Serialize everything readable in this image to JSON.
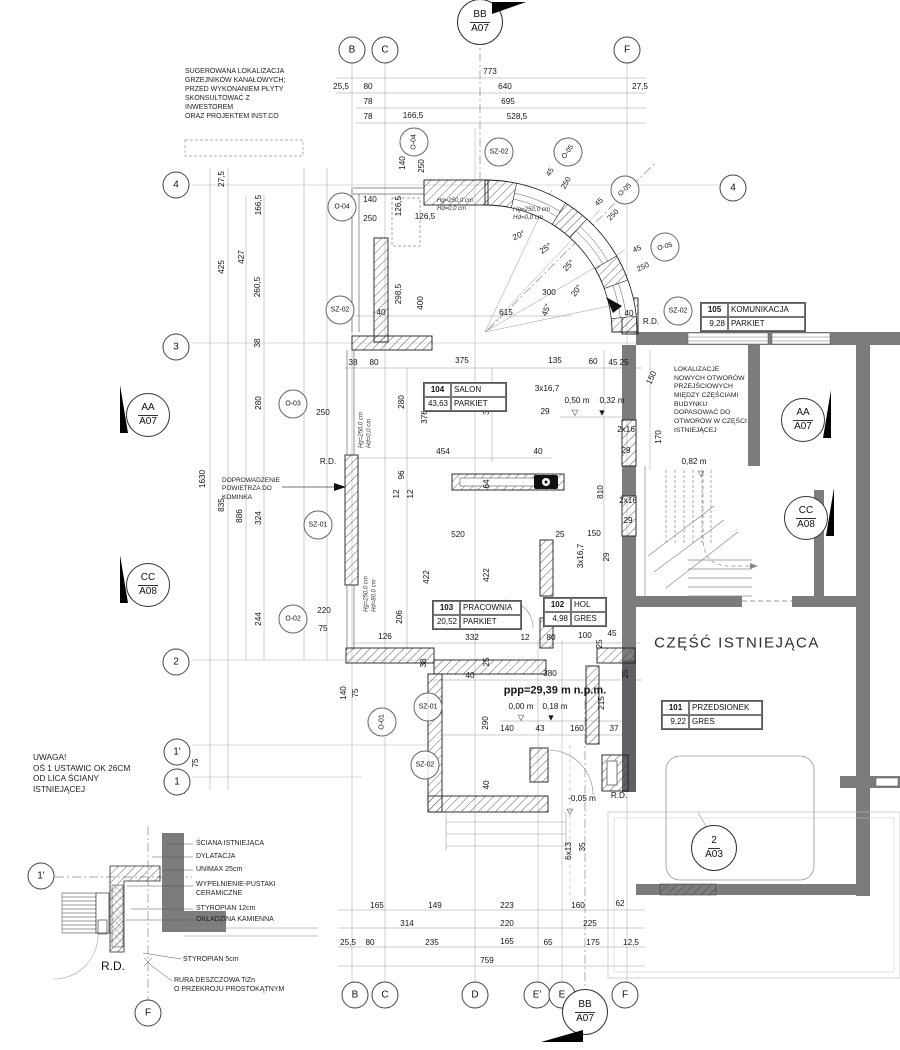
{
  "colors": {
    "existing_wall": "#7c7c7c",
    "existing_wall_dark": "#606165",
    "line": "#555555",
    "dim_text": "#141414",
    "bg": "#ffffff"
  },
  "plan": {
    "big_label": {
      "t": "CZĘŚĆ ISTNIEJĄCA",
      "x": 737,
      "y": 643
    },
    "notes": [
      {
        "n": "note-suggested-heaters",
        "t": "SUGEROWANA LOKALIZACJA\nGRZEJNIKÓW KANAŁOWYCH;\nPRZED WYKONANIEM PŁYTY\nSKONSULTOWAĆ Z\nINWESTOREM\nORAZ PROJEKTEM INST.CO",
        "x": 185,
        "y": 68,
        "fs": 7
      },
      {
        "n": "note-new-openings",
        "t": "LOKALIZACJE\nNOWYCH OTWORÓW\nPRZEJŚCIOWYCH\nMIĘDZY CZĘŚCIAMI\nBUDYNKU\nDOPASOWAĆ DO\nOTWORÓW W CZĘŚCI\nISTNIEJĄCEJ",
        "x": 674,
        "y": 366,
        "fs": 6.8
      },
      {
        "n": "note-axis-warning",
        "t": "UWAGA!\nOŚ 1 USTAWIC OK 26CM\nOD LICA ŚCIANY\nISTNIEJĄCEJ",
        "x": 33,
        "y": 752,
        "fs": 8.3
      },
      {
        "n": "note-fireplace-air",
        "t": "DOPROWADZENIE\nPOWIETRZA DO\nKOMINKA",
        "x": 222,
        "y": 477,
        "fs": 6.5
      },
      {
        "n": "window-params",
        "t": "Hg=250,0 cm\nHd=0,0 cm",
        "x": 437,
        "y": 198,
        "fs": 6,
        "i": 1
      },
      {
        "n": "window-params",
        "t": "Hg=250,0 cm\nHd=0,0 cm",
        "x": 513,
        "y": 206,
        "fs": 6.2,
        "i": 1
      },
      {
        "n": "window-params",
        "t": "Hg=250,0 cm\nHd=0,0 cm",
        "x": 366,
        "y": 430,
        "fs": 6,
        "i": 1,
        "r": -90
      },
      {
        "n": "window-params",
        "t": "Hg=250,0 cm\nHd=80,0 cm",
        "x": 371,
        "y": 594,
        "fs": 6,
        "i": 1,
        "r": -90
      },
      {
        "n": "detail-label",
        "t": "ŚCIANA ISTNIEJĄCA",
        "x": 196,
        "y": 840,
        "fs": 7
      },
      {
        "n": "detail-label",
        "t": "DYLATACJA",
        "x": 196,
        "y": 853,
        "fs": 7
      },
      {
        "n": "detail-label",
        "t": "UNIMAX 25cm",
        "x": 196,
        "y": 866,
        "fs": 7
      },
      {
        "n": "detail-label",
        "t": "WYPEŁNIENIE-PUSTAKI\nCERAMICZNE",
        "x": 196,
        "y": 881,
        "fs": 7
      },
      {
        "n": "detail-label",
        "t": "STYROPIAN 12cm",
        "x": 196,
        "y": 905,
        "fs": 7
      },
      {
        "n": "detail-label",
        "t": "OKŁADZINA KAMIENNA",
        "x": 196,
        "y": 916,
        "fs": 7
      },
      {
        "n": "detail-label",
        "t": "STYROPIAN 5cm",
        "x": 183,
        "y": 956,
        "fs": 7
      },
      {
        "n": "detail-label",
        "t": "RURA DESZCZOWA TiZn\nO PRZEKROJU PROSTOKĄTNYM",
        "x": 174,
        "y": 977,
        "fs": 7
      }
    ],
    "rooms": [
      {
        "num": "104",
        "name": "SALON",
        "area": "43,63",
        "fin": "PARKIET",
        "x": 423,
        "y": 382,
        "w": 82
      },
      {
        "num": "103",
        "name": "PRACOWNIA",
        "area": "20,52",
        "fin": "PARKIET",
        "x": 432,
        "y": 600,
        "w": 88
      },
      {
        "num": "102",
        "name": "HOL",
        "area": "4,98",
        "fin": "GRES",
        "x": 543,
        "y": 597,
        "w": 62
      },
      {
        "num": "105",
        "name": "KOMUNIKACJA",
        "area": "9,28",
        "fin": "PARKIET",
        "x": 700,
        "y": 302,
        "w": 104
      },
      {
        "num": "101",
        "name": "PRZEDSIONEK",
        "area": "9,22",
        "fin": "GRES",
        "x": 661,
        "y": 700,
        "w": 100
      }
    ],
    "grid_bubbles": [
      {
        "t": "B",
        "x": 352,
        "y": 50
      },
      {
        "t": "C",
        "x": 385,
        "y": 50
      },
      {
        "t": "F",
        "x": 627,
        "y": 50
      },
      {
        "t": "4",
        "x": 733,
        "y": 188
      },
      {
        "t": "4",
        "x": 176,
        "y": 185
      },
      {
        "t": "3",
        "x": 176,
        "y": 347
      },
      {
        "t": "2",
        "x": 176,
        "y": 662
      },
      {
        "t": "1'",
        "x": 177,
        "y": 752
      },
      {
        "t": "1",
        "x": 177,
        "y": 782
      },
      {
        "t": "B",
        "x": 355,
        "y": 995
      },
      {
        "t": "C",
        "x": 385,
        "y": 995
      },
      {
        "t": "D",
        "x": 475,
        "y": 995
      },
      {
        "t": "E'",
        "x": 537,
        "y": 995
      },
      {
        "t": "E",
        "x": 562,
        "y": 995
      },
      {
        "t": "F",
        "x": 625,
        "y": 995
      },
      {
        "t": "1'",
        "x": 41,
        "y": 876
      },
      {
        "t": "F",
        "x": 148,
        "y": 1013
      }
    ],
    "tag_bubbles": [
      {
        "t": "O-04",
        "x": 342,
        "y": 207
      },
      {
        "t": "O-04",
        "x": 414,
        "y": 142,
        "r": -90
      },
      {
        "t": "SZ-02",
        "x": 499,
        "y": 152
      },
      {
        "t": "O-05",
        "x": 568,
        "y": 152,
        "r": -55
      },
      {
        "t": "O-05",
        "x": 625,
        "y": 190,
        "r": -45
      },
      {
        "t": "O-05",
        "x": 665,
        "y": 247,
        "r": -15
      },
      {
        "t": "SZ-02",
        "x": 340,
        "y": 310
      },
      {
        "t": "O-03",
        "x": 293,
        "y": 404
      },
      {
        "t": "SZ-01",
        "x": 318,
        "y": 525
      },
      {
        "t": "O-02",
        "x": 293,
        "y": 619
      },
      {
        "t": "O-01",
        "x": 382,
        "y": 722,
        "r": -90
      },
      {
        "t": "SZ-01",
        "x": 428,
        "y": 707
      },
      {
        "t": "SZ-02",
        "x": 425,
        "y": 765
      },
      {
        "t": "SZ-02",
        "x": 678,
        "y": 311
      }
    ],
    "section_markers": [
      {
        "t1": "BB",
        "t2": "A07",
        "x": 480,
        "y": 22,
        "d": 44,
        "flag": "tr"
      },
      {
        "t1": "AA",
        "t2": "A07",
        "x": 148,
        "y": 415,
        "d": 42,
        "flag": "lu"
      },
      {
        "t1": "CC",
        "t2": "A08",
        "x": 148,
        "y": 585,
        "d": 42,
        "flag": "lu"
      },
      {
        "t1": "AA",
        "t2": "A07",
        "x": 803,
        "y": 420,
        "d": 42,
        "flag": "ru"
      },
      {
        "t1": "CC",
        "t2": "A08",
        "x": 806,
        "y": 518,
        "d": 42,
        "flag": "ru"
      },
      {
        "t1": "BB",
        "t2": "A07",
        "x": 585,
        "y": 1012,
        "d": 44,
        "flag": "bl"
      },
      {
        "t1": "2",
        "t2": "A03",
        "x": 714,
        "y": 848,
        "d": 44,
        "flag": ""
      }
    ],
    "labels": [
      {
        "t": "773",
        "x": 490,
        "y": 72
      },
      {
        "t": "25,5",
        "x": 341,
        "y": 87
      },
      {
        "t": "80",
        "x": 368,
        "y": 87
      },
      {
        "t": "640",
        "x": 505,
        "y": 87
      },
      {
        "t": "27,5",
        "x": 640,
        "y": 87
      },
      {
        "t": "78",
        "x": 368,
        "y": 102
      },
      {
        "t": "695",
        "x": 508,
        "y": 102
      },
      {
        "t": "78",
        "x": 368,
        "y": 117
      },
      {
        "t": "166,5",
        "x": 413,
        "y": 116
      },
      {
        "t": "528,5",
        "x": 517,
        "y": 117
      },
      {
        "t": "27,5",
        "x": 222,
        "y": 179,
        "r": -90
      },
      {
        "t": "166,5",
        "x": 259,
        "y": 205,
        "r": -90
      },
      {
        "t": "425",
        "x": 222,
        "y": 267,
        "r": -90
      },
      {
        "t": "427",
        "x": 242,
        "y": 257,
        "r": -90
      },
      {
        "t": "260,5",
        "x": 258,
        "y": 287,
        "r": -90
      },
      {
        "t": "38",
        "x": 258,
        "y": 343,
        "r": -90
      },
      {
        "t": "280",
        "x": 259,
        "y": 403,
        "r": -90
      },
      {
        "t": "1630",
        "x": 203,
        "y": 479,
        "r": -90
      },
      {
        "t": "835",
        "x": 222,
        "y": 505,
        "r": -90
      },
      {
        "t": "886",
        "x": 240,
        "y": 516,
        "r": -90
      },
      {
        "t": "324",
        "x": 259,
        "y": 518,
        "r": -90
      },
      {
        "t": "244",
        "x": 259,
        "y": 619,
        "r": -90
      },
      {
        "t": "75",
        "x": 196,
        "y": 763,
        "r": -90
      },
      {
        "t": "27,5",
        "x": 183,
        "y": 786,
        "r": -90
      },
      {
        "t": "250",
        "x": 323,
        "y": 413
      },
      {
        "t": "220",
        "x": 324,
        "y": 611
      },
      {
        "t": "75",
        "x": 323,
        "y": 629
      },
      {
        "t": "R.D.",
        "x": 328,
        "y": 462
      },
      {
        "t": "140",
        "x": 370,
        "y": 200
      },
      {
        "t": "250",
        "x": 370,
        "y": 219
      },
      {
        "t": "140",
        "x": 403,
        "y": 163,
        "r": -90
      },
      {
        "t": "250",
        "x": 422,
        "y": 166,
        "r": -90
      },
      {
        "t": "126,5",
        "x": 399,
        "y": 206,
        "r": -90
      },
      {
        "t": "126,5",
        "x": 425,
        "y": 217
      },
      {
        "t": "298,5",
        "x": 399,
        "y": 294,
        "r": -90
      },
      {
        "t": "400",
        "x": 421,
        "y": 303,
        "r": -90
      },
      {
        "t": "40",
        "x": 381,
        "y": 313
      },
      {
        "t": "615",
        "x": 506,
        "y": 313
      },
      {
        "t": "300",
        "x": 549,
        "y": 293
      },
      {
        "t": "45",
        "x": 550,
        "y": 172,
        "r": -60,
        "fs": 7.5
      },
      {
        "t": "250",
        "x": 566,
        "y": 183,
        "r": -60,
        "fs": 7.5
      },
      {
        "t": "45",
        "x": 599,
        "y": 202,
        "r": -45,
        "fs": 7.5
      },
      {
        "t": "250",
        "x": 613,
        "y": 215,
        "r": -45,
        "fs": 7.5
      },
      {
        "t": "45",
        "x": 637,
        "y": 249,
        "r": -25,
        "fs": 7.5
      },
      {
        "t": "250",
        "x": 643,
        "y": 267,
        "r": -25,
        "fs": 7.5
      },
      {
        "t": "20°",
        "x": 519,
        "y": 236,
        "r": -25
      },
      {
        "t": "25°",
        "x": 546,
        "y": 249,
        "r": -35
      },
      {
        "t": "25°",
        "x": 569,
        "y": 266,
        "r": -45
      },
      {
        "t": "20°",
        "x": 577,
        "y": 291,
        "r": -55
      },
      {
        "t": "45°",
        "x": 547,
        "y": 310,
        "r": -70
      },
      {
        "t": "38",
        "x": 353,
        "y": 363
      },
      {
        "t": "80",
        "x": 374,
        "y": 363
      },
      {
        "t": "375",
        "x": 462,
        "y": 361
      },
      {
        "t": "135",
        "x": 555,
        "y": 361
      },
      {
        "t": "60",
        "x": 593,
        "y": 362
      },
      {
        "t": "45",
        "x": 613,
        "y": 363
      },
      {
        "t": "25",
        "x": 624,
        "y": 363
      },
      {
        "t": "3x16,7",
        "x": 547,
        "y": 389
      },
      {
        "t": "29",
        "x": 545,
        "y": 412
      },
      {
        "t": "0,50 m",
        "x": 577,
        "y": 401
      },
      {
        "t": "0,32 m",
        "x": 612,
        "y": 401
      },
      {
        "t": "▽",
        "x": 575,
        "y": 413,
        "fs": 8
      },
      {
        "t": "▼",
        "x": 602,
        "y": 413,
        "fs": 9
      },
      {
        "t": "2x16",
        "x": 626,
        "y": 430
      },
      {
        "t": "29",
        "x": 626,
        "y": 451
      },
      {
        "t": "150",
        "x": 652,
        "y": 378,
        "r": -65
      },
      {
        "t": "170",
        "x": 659,
        "y": 437,
        "r": -90
      },
      {
        "t": "280",
        "x": 402,
        "y": 402,
        "r": -90
      },
      {
        "t": "376",
        "x": 425,
        "y": 417,
        "r": -90
      },
      {
        "t": "324",
        "x": 487,
        "y": 408,
        "r": -90
      },
      {
        "t": "454",
        "x": 443,
        "y": 452
      },
      {
        "t": "40",
        "x": 538,
        "y": 452
      },
      {
        "t": "96",
        "x": 402,
        "y": 475,
        "r": -90
      },
      {
        "t": "12",
        "x": 397,
        "y": 494,
        "r": -90
      },
      {
        "t": "12",
        "x": 411,
        "y": 494,
        "r": -90
      },
      {
        "t": "64",
        "x": 487,
        "y": 484,
        "r": -90
      },
      {
        "t": "810",
        "x": 601,
        "y": 492,
        "r": -90
      },
      {
        "t": "2x16",
        "x": 628,
        "y": 501
      },
      {
        "t": "29",
        "x": 628,
        "y": 521
      },
      {
        "t": "R.D.",
        "x": 651,
        "y": 322
      },
      {
        "t": "40",
        "x": 629,
        "y": 314
      },
      {
        "t": "520",
        "x": 458,
        "y": 535
      },
      {
        "t": "25",
        "x": 560,
        "y": 535
      },
      {
        "t": "150",
        "x": 594,
        "y": 534
      },
      {
        "t": "3x16,7",
        "x": 581,
        "y": 556,
        "r": -90
      },
      {
        "t": "29",
        "x": 607,
        "y": 557,
        "r": -90
      },
      {
        "t": "422",
        "x": 427,
        "y": 577,
        "r": -90
      },
      {
        "t": "422",
        "x": 487,
        "y": 575,
        "r": -90
      },
      {
        "t": "206",
        "x": 400,
        "y": 617,
        "r": -90
      },
      {
        "t": "126",
        "x": 385,
        "y": 637
      },
      {
        "t": "332",
        "x": 472,
        "y": 638
      },
      {
        "t": "12",
        "x": 525,
        "y": 638
      },
      {
        "t": "80",
        "x": 551,
        "y": 638
      },
      {
        "t": "100",
        "x": 585,
        "y": 636
      },
      {
        "t": "45",
        "x": 612,
        "y": 634
      },
      {
        "t": "25",
        "x": 600,
        "y": 644,
        "r": -90
      },
      {
        "t": "38",
        "x": 424,
        "y": 663,
        "r": -90
      },
      {
        "t": "25",
        "x": 487,
        "y": 662,
        "r": -90
      },
      {
        "t": "40",
        "x": 470,
        "y": 676
      },
      {
        "t": "380",
        "x": 550,
        "y": 674
      },
      {
        "t": "25",
        "x": 626,
        "y": 674,
        "r": -90
      },
      {
        "t": "140",
        "x": 344,
        "y": 693,
        "r": -90
      },
      {
        "t": "75",
        "x": 356,
        "y": 693,
        "r": -90
      },
      {
        "t": "ppp=29,39 m n.p.m.",
        "x": 555,
        "y": 691,
        "fs": 11,
        "b": 1
      },
      {
        "t": "0,00 m",
        "x": 521,
        "y": 707
      },
      {
        "t": "0,18 m",
        "x": 555,
        "y": 707
      },
      {
        "t": "▽",
        "x": 521,
        "y": 718,
        "fs": 8
      },
      {
        "t": "▼",
        "x": 551,
        "y": 718,
        "fs": 9
      },
      {
        "t": "215",
        "x": 602,
        "y": 703,
        "r": -90
      },
      {
        "t": "290",
        "x": 486,
        "y": 723,
        "r": -90
      },
      {
        "t": "140",
        "x": 507,
        "y": 729
      },
      {
        "t": "43",
        "x": 540,
        "y": 729
      },
      {
        "t": "160",
        "x": 577,
        "y": 729
      },
      {
        "t": "37",
        "x": 614,
        "y": 729
      },
      {
        "t": "40",
        "x": 487,
        "y": 785,
        "r": -90
      },
      {
        "t": "-0,05 m",
        "x": 582,
        "y": 799
      },
      {
        "t": "▽",
        "x": 570,
        "y": 812,
        "fs": 8
      },
      {
        "t": "R.D.",
        "x": 619,
        "y": 796
      },
      {
        "t": "6x13",
        "x": 569,
        "y": 851,
        "r": -90
      },
      {
        "t": "35",
        "x": 583,
        "y": 847,
        "r": -90
      },
      {
        "t": "0,82 m",
        "x": 694,
        "y": 462
      },
      {
        "t": "▽",
        "x": 701,
        "y": 474,
        "fs": 8
      },
      {
        "t": "165",
        "x": 377,
        "y": 906
      },
      {
        "t": "149",
        "x": 435,
        "y": 906
      },
      {
        "t": "223",
        "x": 507,
        "y": 906
      },
      {
        "t": "160",
        "x": 578,
        "y": 906
      },
      {
        "t": "62",
        "x": 620,
        "y": 904
      },
      {
        "t": "314",
        "x": 407,
        "y": 924
      },
      {
        "t": "220",
        "x": 507,
        "y": 924
      },
      {
        "t": "225",
        "x": 590,
        "y": 924
      },
      {
        "t": "25,5",
        "x": 348,
        "y": 943
      },
      {
        "t": "80",
        "x": 370,
        "y": 943
      },
      {
        "t": "235",
        "x": 432,
        "y": 943
      },
      {
        "t": "165",
        "x": 507,
        "y": 942
      },
      {
        "t": "65",
        "x": 548,
        "y": 943
      },
      {
        "t": "175",
        "x": 593,
        "y": 943
      },
      {
        "t": "12,5",
        "x": 631,
        "y": 943
      },
      {
        "t": "759",
        "x": 487,
        "y": 961
      },
      {
        "t": "R.D.",
        "x": 113,
        "y": 966,
        "fs": 12
      }
    ]
  }
}
